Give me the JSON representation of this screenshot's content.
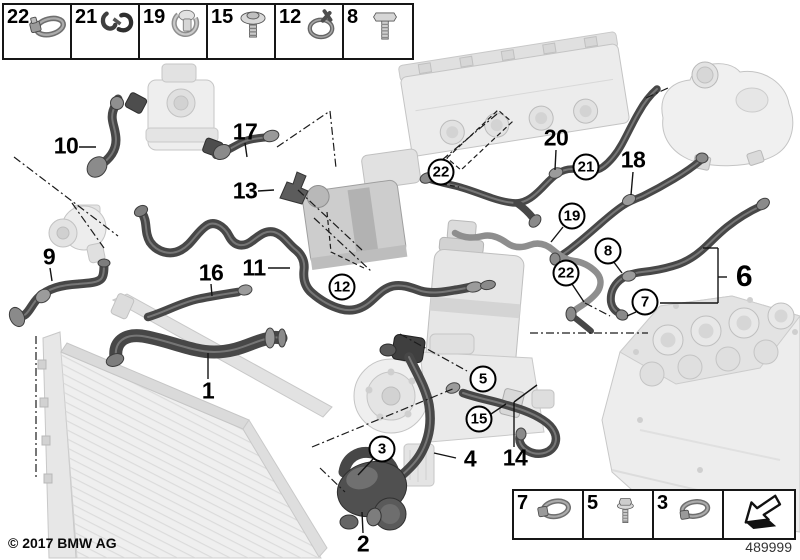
{
  "footer": {
    "copyright": "© 2017 BMW AG",
    "diagram_number": "489999"
  },
  "legend_top": {
    "items": [
      {
        "number": "22",
        "icon": "hose-clamp"
      },
      {
        "number": "21",
        "icon": "spring-clip"
      },
      {
        "number": "19",
        "icon": "retaining-clip"
      },
      {
        "number": "15",
        "icon": "washer-screw"
      },
      {
        "number": "12",
        "icon": "spring-band-clamp"
      },
      {
        "number": "8",
        "icon": "hex-bolt"
      }
    ]
  },
  "legend_bottom": {
    "items": [
      {
        "number": "7",
        "icon": "hose-clamp"
      },
      {
        "number": "5",
        "icon": "flange-bolt"
      },
      {
        "number": "3",
        "icon": "hose-clamp"
      },
      {
        "number": "",
        "icon": "direction-arrow"
      }
    ]
  },
  "callouts": {
    "plain": [
      {
        "label": "10"
      },
      {
        "label": "17"
      },
      {
        "label": "13"
      },
      {
        "label": "9"
      },
      {
        "label": "16"
      },
      {
        "label": "11"
      },
      {
        "label": "1"
      },
      {
        "label": "2"
      },
      {
        "label": "4"
      },
      {
        "label": "14"
      },
      {
        "label": "20"
      },
      {
        "label": "18"
      },
      {
        "label": "6"
      }
    ],
    "circled": [
      {
        "label": "12"
      },
      {
        "label": "22"
      },
      {
        "label": "21"
      },
      {
        "label": "19"
      },
      {
        "label": "8"
      },
      {
        "label": "22"
      },
      {
        "label": "7"
      },
      {
        "label": "5"
      },
      {
        "label": "15"
      },
      {
        "label": "3"
      }
    ]
  }
}
